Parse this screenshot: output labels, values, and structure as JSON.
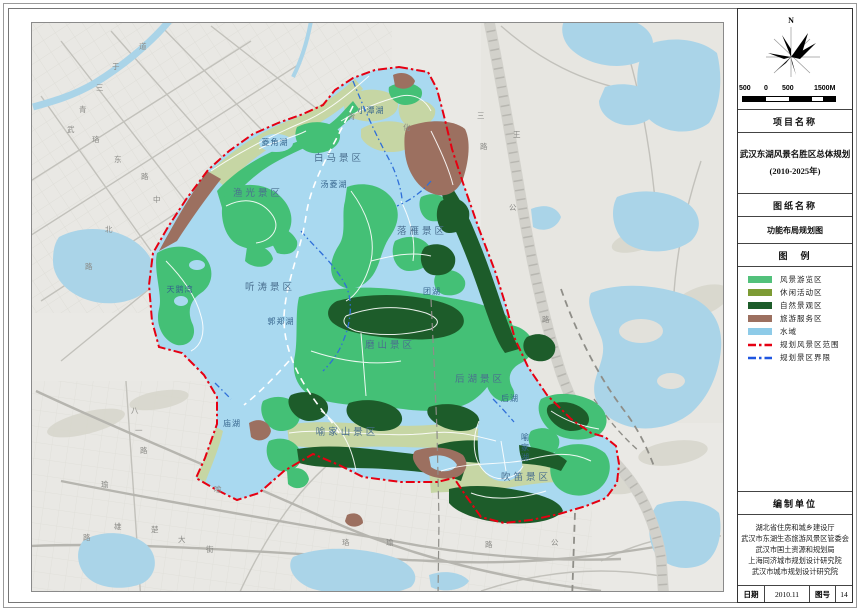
{
  "panel": {
    "north_label": "N",
    "scale": {
      "labels": [
        "500",
        "0",
        "500",
        "1500M"
      ]
    },
    "project_section_title": "项目名称",
    "project_title_line1": "武汉东湖风景名胜区总体规划",
    "project_title_line2": "(2010-2025年)",
    "sheet_section_title": "图纸名称",
    "sheet_title": "功能布局规划图",
    "legend_section_title": "图　例",
    "legend": [
      {
        "label": "风景游览区",
        "color": "#52c17b",
        "type": "fill"
      },
      {
        "label": "休闲活动区",
        "color": "#7d9b34",
        "type": "fill"
      },
      {
        "label": "自然景观区",
        "color": "#1d5c2a",
        "type": "fill"
      },
      {
        "label": "旅游服务区",
        "color": "#9c7060",
        "type": "fill"
      },
      {
        "label": "水域",
        "color": "#8ecbe8",
        "type": "fill"
      },
      {
        "label": "规划风景区范围",
        "color": "#e60012",
        "type": "dashdot-line"
      },
      {
        "label": "规划景区界限",
        "color": "#1f56e0",
        "type": "dashdot-line"
      }
    ],
    "org_section_title": "编制单位",
    "organizations": [
      "湖北省住房和城乡建设厅",
      "武汉市东湖生态旅游风景区管委会",
      "武汉市国土资源和规划局",
      "上海同济城市规划设计研究院",
      "武汉市城市规划设计研究院"
    ],
    "footer": {
      "date_label": "日期",
      "date_value": "2010.11",
      "fig_label": "图号",
      "fig_value": "14"
    }
  },
  "map": {
    "colors": {
      "scenic_tour_green": "#44c076",
      "leisure_sage": "#c6d6a4",
      "natural_dark_green": "#1d5c2a",
      "service_brown": "#9c7060",
      "water_blue": "#a9d9f0",
      "outside_water": "#aad4e8",
      "boundary_red": "#e60012",
      "zone_border_blue": "#2f6fd8",
      "base_grey": "#eae9e5"
    },
    "zone_labels": [
      {
        "text": "白马景区"
      },
      {
        "text": "渔光景区"
      },
      {
        "text": "听涛景区"
      },
      {
        "text": "落雁景区"
      },
      {
        "text": "磨山景区"
      },
      {
        "text": "后湖景区"
      },
      {
        "text": "喻家山景区"
      },
      {
        "text": "吹笛景区"
      }
    ],
    "water_labels": [
      {
        "text": "小潭湖"
      },
      {
        "text": "菱角湖"
      },
      {
        "text": "汤菱湖"
      },
      {
        "text": "郭郑湖"
      },
      {
        "text": "团湖"
      },
      {
        "text": "后湖"
      },
      {
        "text": "庙湖"
      },
      {
        "text": "天鹅湾"
      },
      {
        "text": "喻家湖"
      }
    ],
    "road_chars": [
      {
        "ch": "道"
      },
      {
        "ch": "于"
      },
      {
        "ch": "三"
      },
      {
        "ch": "青"
      },
      {
        "ch": "武"
      },
      {
        "ch": "珞"
      },
      {
        "ch": "东"
      },
      {
        "ch": "路"
      },
      {
        "ch": "中"
      },
      {
        "ch": "北"
      },
      {
        "ch": "路"
      },
      {
        "ch": "三"
      },
      {
        "ch": "路"
      },
      {
        "ch": "王"
      },
      {
        "ch": "公"
      },
      {
        "ch": "路"
      },
      {
        "ch": "八"
      },
      {
        "ch": "一"
      },
      {
        "ch": "路"
      },
      {
        "ch": "瑜"
      },
      {
        "ch": "雄"
      },
      {
        "ch": "楚"
      },
      {
        "ch": "大"
      },
      {
        "ch": "街"
      },
      {
        "ch": "喻"
      },
      {
        "ch": "路"
      },
      {
        "ch": "珞"
      },
      {
        "ch": "瑜"
      },
      {
        "ch": "路"
      },
      {
        "ch": "公"
      },
      {
        "ch": "青"
      },
      {
        "ch": "化"
      }
    ]
  }
}
